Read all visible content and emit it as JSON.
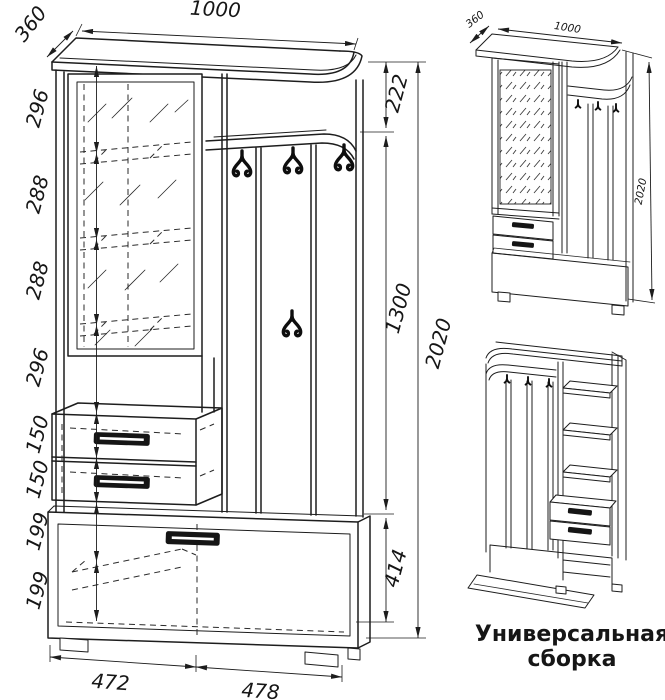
{
  "drawing": {
    "front_view": {
      "top_width": "1000",
      "top_depth": "360",
      "left_chain": [
        "296",
        "288",
        "288",
        "296",
        "150",
        "150",
        "199",
        "199"
      ],
      "right_chain": [
        "222",
        "1300",
        "414"
      ],
      "total_height": "2020",
      "bottom_widths": [
        "472",
        "478"
      ]
    },
    "iso_view": {
      "depth": "360",
      "width": "1000",
      "height": "2020"
    },
    "caption": {
      "line1": "Универсальная",
      "line2": "сборка"
    }
  },
  "colors": {
    "line": "#1d1d1d",
    "background": "#ffffff"
  }
}
